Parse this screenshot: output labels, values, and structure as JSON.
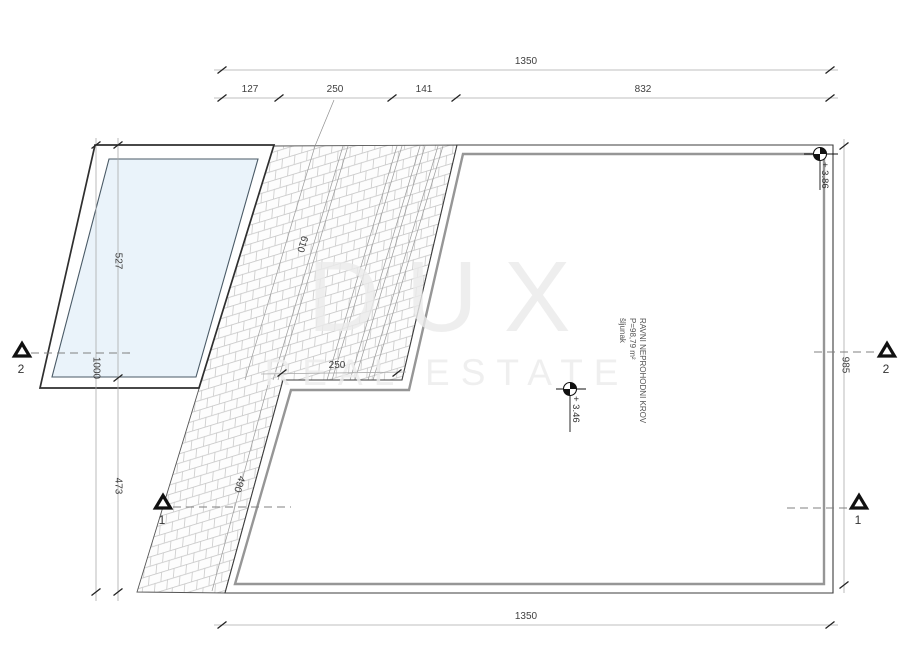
{
  "watermark": {
    "brand": "DUX",
    "tagline": "REAL ESTATE"
  },
  "room": {
    "name": "RAVNI NEPROHODNI KROV",
    "area": "P=98,79 m²",
    "material": "šljunak"
  },
  "levels": {
    "roof_level": "+ 3.46",
    "parapet_level": "+ 3.86"
  },
  "sections": {
    "section_1": "1",
    "section_2": "2"
  },
  "dimensions": {
    "top_total": "1350",
    "top_seg_1": "127",
    "top_seg_2": "250",
    "top_seg_3": "141",
    "top_seg_4": "832",
    "bottom_total": "1350",
    "left_total": "1000",
    "left_seg_upper": "527",
    "left_seg_lower": "473",
    "right_height": "985",
    "ramp_length_upper": "610",
    "ramp_length_lower": "490",
    "ramp_step_width": "250"
  }
}
